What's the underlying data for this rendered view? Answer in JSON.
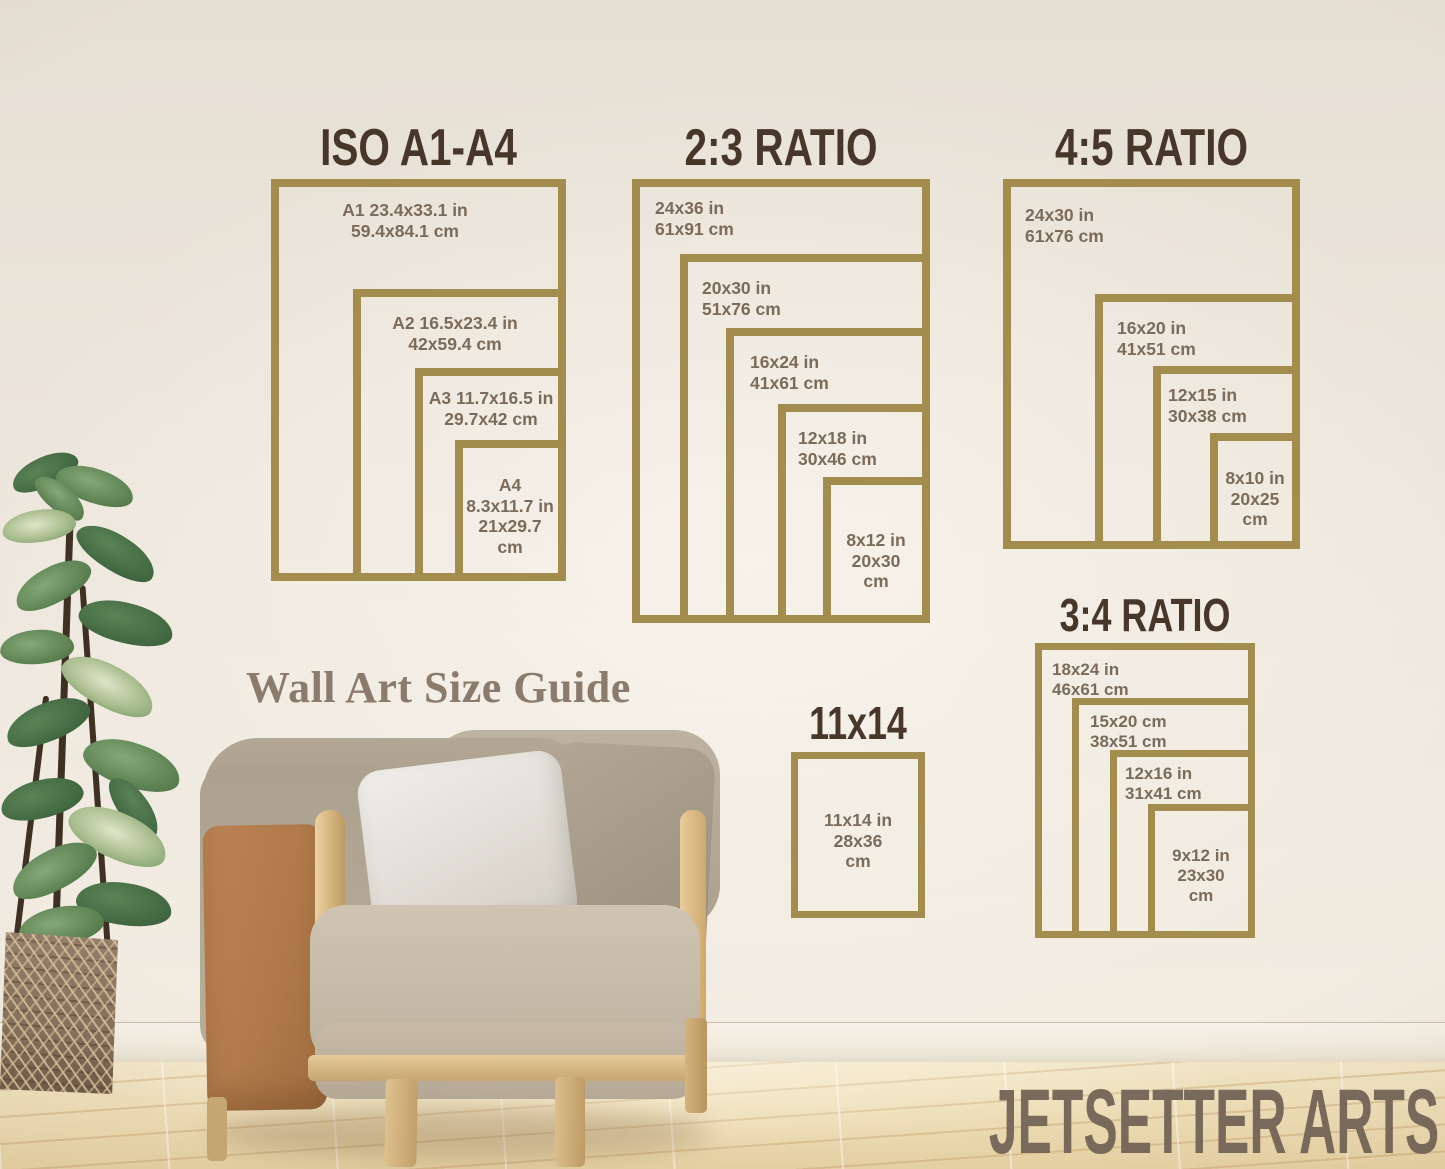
{
  "scene": {
    "caption": "Wall Art Size Guide",
    "watermark": "JETSETTER ARTS"
  },
  "colors": {
    "frame_gold": "#a28c4e",
    "title_brown": "#47362a",
    "label_taupe": "#7b6b5b",
    "caption_taupe": "#8b7b6c",
    "watermark_taupe": "#796a5c"
  },
  "groups": [
    {
      "title": "ISO A1-A4",
      "frames": [
        {
          "lines": [
            "A1 23.4x33.1 in",
            "59.4x84.1 cm"
          ]
        },
        {
          "lines": [
            "A2 16.5x23.4 in",
            "42x59.4 cm"
          ]
        },
        {
          "lines": [
            "A3 11.7x16.5 in",
            "29.7x42 cm"
          ]
        },
        {
          "lines": [
            "A4",
            "8.3x11.7 in",
            "21x29.7",
            "cm"
          ]
        }
      ]
    },
    {
      "title": "2:3 RATIO",
      "frames": [
        {
          "lines": [
            "24x36 in",
            "61x91 cm"
          ]
        },
        {
          "lines": [
            "20x30 in",
            "51x76 cm"
          ]
        },
        {
          "lines": [
            "16x24 in",
            "41x61 cm"
          ]
        },
        {
          "lines": [
            "12x18 in",
            "30x46 cm"
          ]
        },
        {
          "lines": [
            "8x12 in",
            "20x30",
            "cm"
          ]
        }
      ]
    },
    {
      "title": "4:5 RATIO",
      "frames": [
        {
          "lines": [
            "24x30 in",
            "61x76 cm"
          ]
        },
        {
          "lines": [
            "16x20 in",
            "41x51 cm"
          ]
        },
        {
          "lines": [
            "12x15 in",
            "30x38 cm"
          ]
        },
        {
          "lines": [
            "8x10 in",
            "20x25",
            "cm"
          ]
        }
      ]
    },
    {
      "title": "3:4 RATIO",
      "frames": [
        {
          "lines": [
            "18x24 in",
            "46x61 cm"
          ]
        },
        {
          "lines": [
            "15x20 cm",
            "38x51 cm"
          ]
        },
        {
          "lines": [
            "12x16 in",
            "31x41 cm"
          ]
        },
        {
          "lines": [
            "9x12 in",
            "23x30",
            "cm"
          ]
        }
      ]
    },
    {
      "title": "11x14",
      "frames": [
        {
          "lines": [
            "11x14 in",
            "28x36",
            "cm"
          ]
        }
      ]
    }
  ]
}
